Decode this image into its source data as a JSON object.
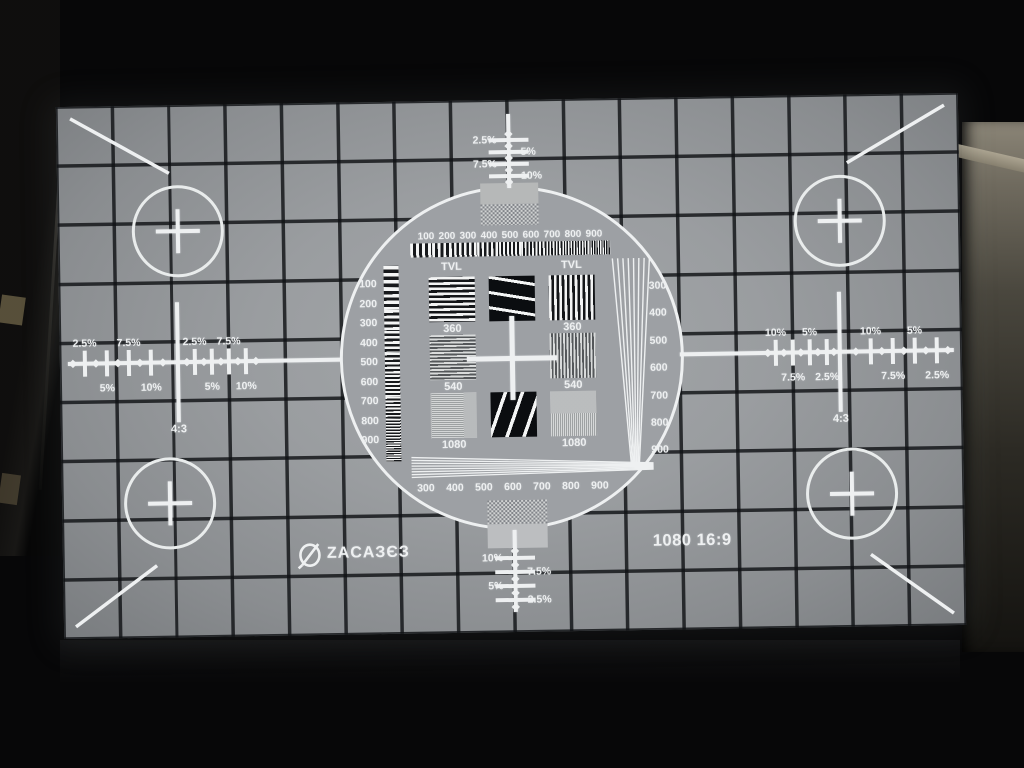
{
  "scene": {
    "description": "Photograph of a dark room with a projector displaying a 1080 16:9 monoscope test pattern on a screen",
    "format_label": "1080 16:9",
    "logo_text": "ZACAЗЄЗ",
    "aspect_marker": "4:3"
  },
  "pattern": {
    "tvl_label": "TVL",
    "row_labels": {
      "row1": "360",
      "row2": "540",
      "row3": "1080"
    },
    "top_scale_labels": [
      "2.5%",
      "5%",
      "7.5%",
      "10%"
    ],
    "bottom_scale_labels": [
      "10%",
      "7.5%",
      "5%",
      "2.5%"
    ],
    "left_ruler_labels_above": [
      "2.5%",
      "7.5%",
      "2.5%",
      "7.5%"
    ],
    "left_ruler_labels_below": [
      "5%",
      "10%",
      "5%",
      "10%"
    ],
    "right_ruler_labels_above": [
      "10%",
      "5%",
      "10%",
      "5%"
    ],
    "right_ruler_labels_below": [
      "7.5%",
      "2.5%",
      "7.5%",
      "2.5%"
    ],
    "left_wedge_numbers": [
      "100",
      "200",
      "300",
      "400",
      "500",
      "600",
      "700",
      "800",
      "900"
    ],
    "top_wedge_numbers": [
      "100",
      "200",
      "300",
      "400",
      "500",
      "600",
      "700",
      "800",
      "900"
    ],
    "right_wedge_numbers": [
      "300",
      "400",
      "500",
      "600",
      "700",
      "800",
      "900"
    ],
    "bottom_wedge_numbers": [
      "300",
      "400",
      "500",
      "600",
      "700",
      "800",
      "900"
    ]
  },
  "colors": {
    "screen_gray": "#9a9da0",
    "grid_line": "#17191c",
    "marking_white": "#eef0f1",
    "test_black": "#0b0d10",
    "room_black": "#070708",
    "wall_tan": "#8b8577"
  }
}
